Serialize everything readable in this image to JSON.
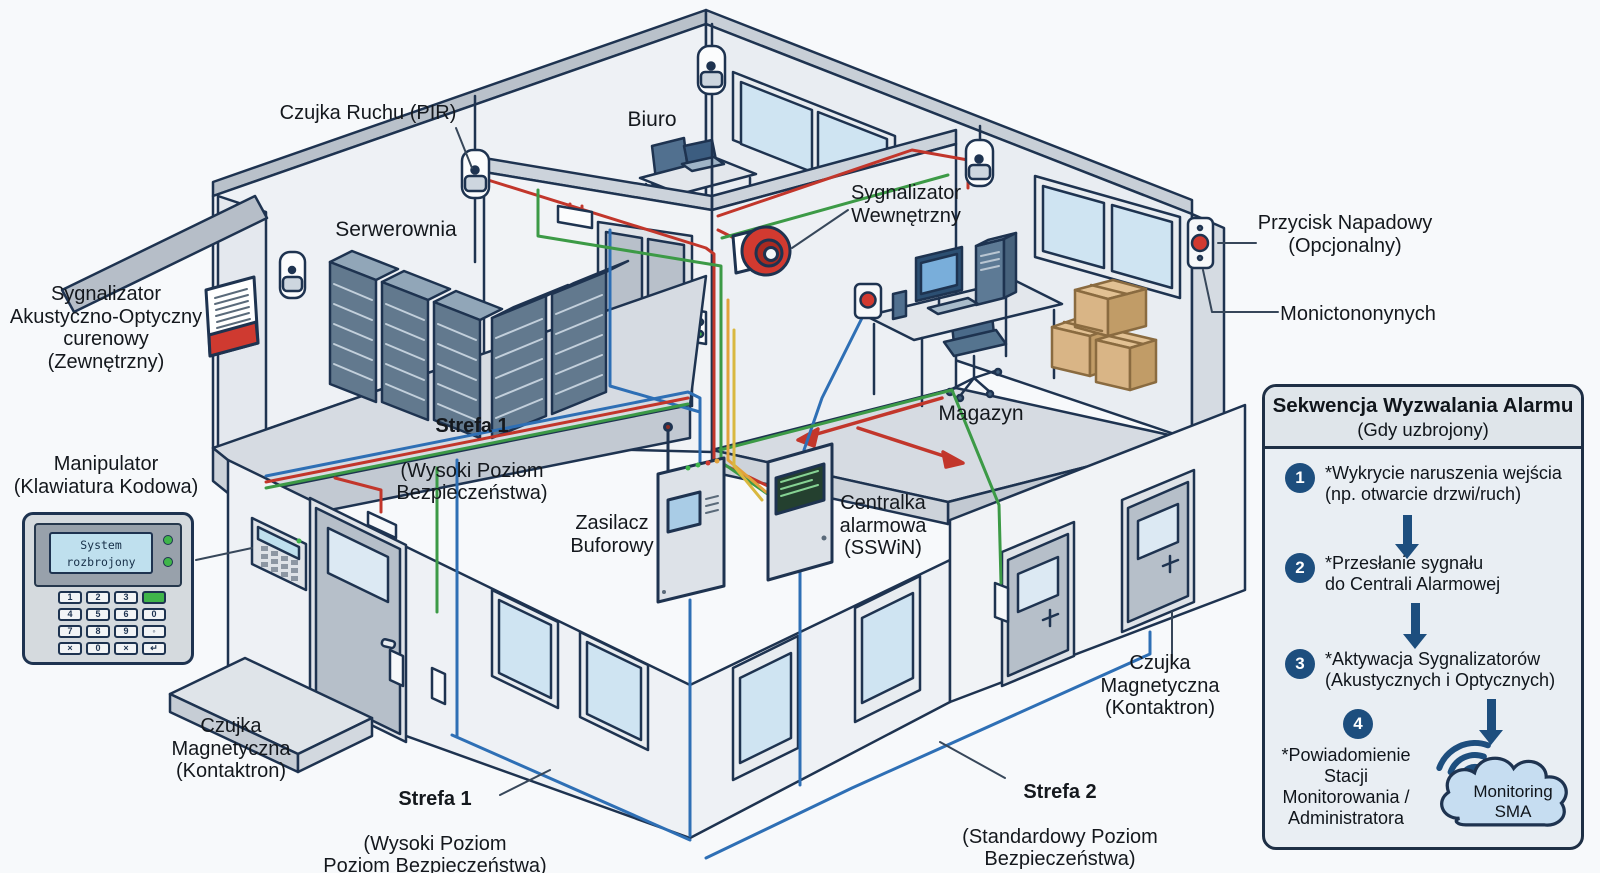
{
  "diagram_title": "System Sygnalizacji Włamania i Napadu (SSWiN) – schemat izometryczny",
  "colors": {
    "outline": "#1e3350",
    "wire_red": "#c2362b",
    "wire_green": "#3c9a46",
    "wire_blue": "#2e6fb5",
    "wire_orange": "#e2a23c",
    "siren_red": "#d23a30",
    "step_circle": "#1d4e7e",
    "cloud_fill": "#c6ddf1",
    "led_green": "#3fb54a",
    "box_tan": "#d9b586"
  },
  "labels": {
    "czujka_ruchu": "Czujka Ruchu (PIR)",
    "biuro": "Biuro",
    "serwerownia": "Serwerownia",
    "magazyn": "Magazyn",
    "sygnalizator_wewnetrzny": "Sygnalizator\nWewnętrzny",
    "przycisk_napadowy": "Przycisk Napadowy\n(Opcjonalny)",
    "monictononynych": "Monictononynych",
    "sygnalizator_zewnetrzny": "Sygnalizator\nAkustyczno-Optyczny\ncurenowy\n(Zewnętrzny)",
    "manipulator": "Manipulator\n(Klawiatura Kodowa)",
    "zasilacz": "Zasilacz\nBuforowy",
    "centralka": "Centralka\nalarmowa\n(SSWiN)",
    "strefa1_roof": {
      "title": "Strefa 1",
      "sub": "(Wysoki Poziom\nBezpieczeństwa)"
    },
    "strefa1_bottom": {
      "title": "Strefa 1",
      "sub": "(Wysoki Poziom\nPoziom Bezpieczeństwa)"
    },
    "strefa2": {
      "title": "Strefa 2",
      "sub": "(Standardowy Poziom\nBezpieczeństwa)"
    },
    "czujka_mag_left": "Czujka\nMagnetyczna\n(Kontaktron)",
    "czujka_mag_right": "Czujka\nMagnetyczna\n(Kontaktron)"
  },
  "keypad": {
    "lcd": "System\nrozbrojony",
    "keys": [
      "1",
      "2",
      "3",
      "",
      "4",
      "5",
      "6",
      "0",
      "7",
      "8",
      "9",
      "◦",
      "×",
      "0",
      "×",
      "↵"
    ]
  },
  "panel": {
    "title": "Sekwencja Wyzwalania Alarmu",
    "subtitle": "(Gdy uzbrojony)",
    "steps": [
      {
        "num": "1",
        "text": "*Wykrycie naruszenia wejścia\n(np. otwarcie drzwi/ruch)"
      },
      {
        "num": "2",
        "text": "*Przesłanie sygnału\ndo Centrali Alarmowej"
      },
      {
        "num": "3",
        "text": "*Aktywacja Sygnalizatorów\n(Akustycznych i Optycznych)"
      },
      {
        "num": "4",
        "text": "*Powiadomienie\nStacji\nMonitorowania /\nAdministratora"
      }
    ],
    "cloud": "Monitoring\nSMA"
  }
}
